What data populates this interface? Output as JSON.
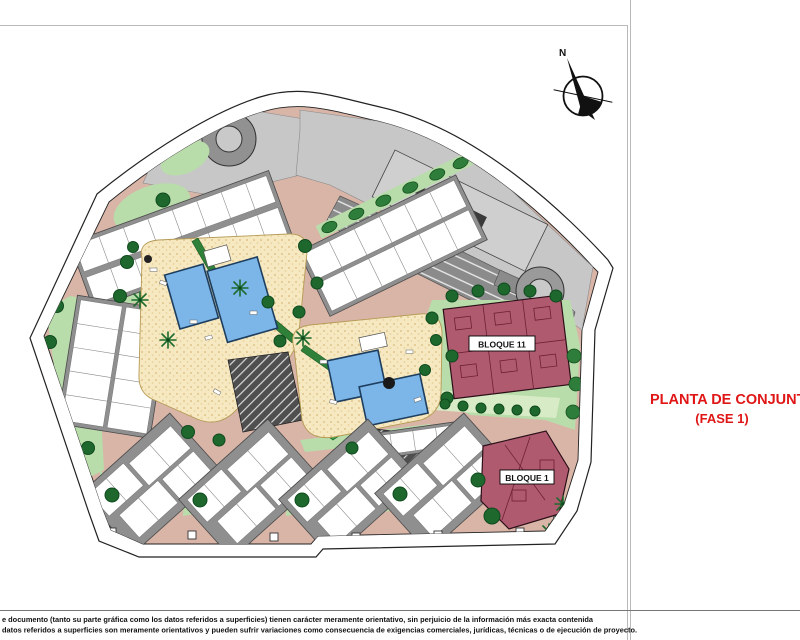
{
  "sheet": {
    "title": {
      "line1": "PLANTA DE CONJUNTO",
      "line2": "(FASE 1)",
      "color": "#e01616"
    },
    "compass": {
      "north_label": "N"
    },
    "disclaimer": {
      "line1": "e documento (tanto su parte gráfica como los datos referidos a superficies) tienen carácter meramente orientativo, sin perjuicio de la información más exacta contenida",
      "line2": "datos referidos a superficies son meramente orientativos y pueden sufrir variaciones como consecuencia de exigencias comerciales, jurídicas, técnicas o de ejecución de proyecto."
    }
  },
  "plan": {
    "building_labels": {
      "bloque_11": "BLOQUE 11",
      "bloque_1": "BLOQUE 1"
    },
    "colors": {
      "road": "#d9b5a7",
      "lawn": "#b9dcab",
      "tree": "#1e682e",
      "courtyard": "#f6e8c1",
      "pool": "#7cb5e8",
      "parking": "#8b8b8b",
      "slab": "#c7c7c7",
      "block": "#b05a70",
      "title_red": "#e01616"
    }
  }
}
